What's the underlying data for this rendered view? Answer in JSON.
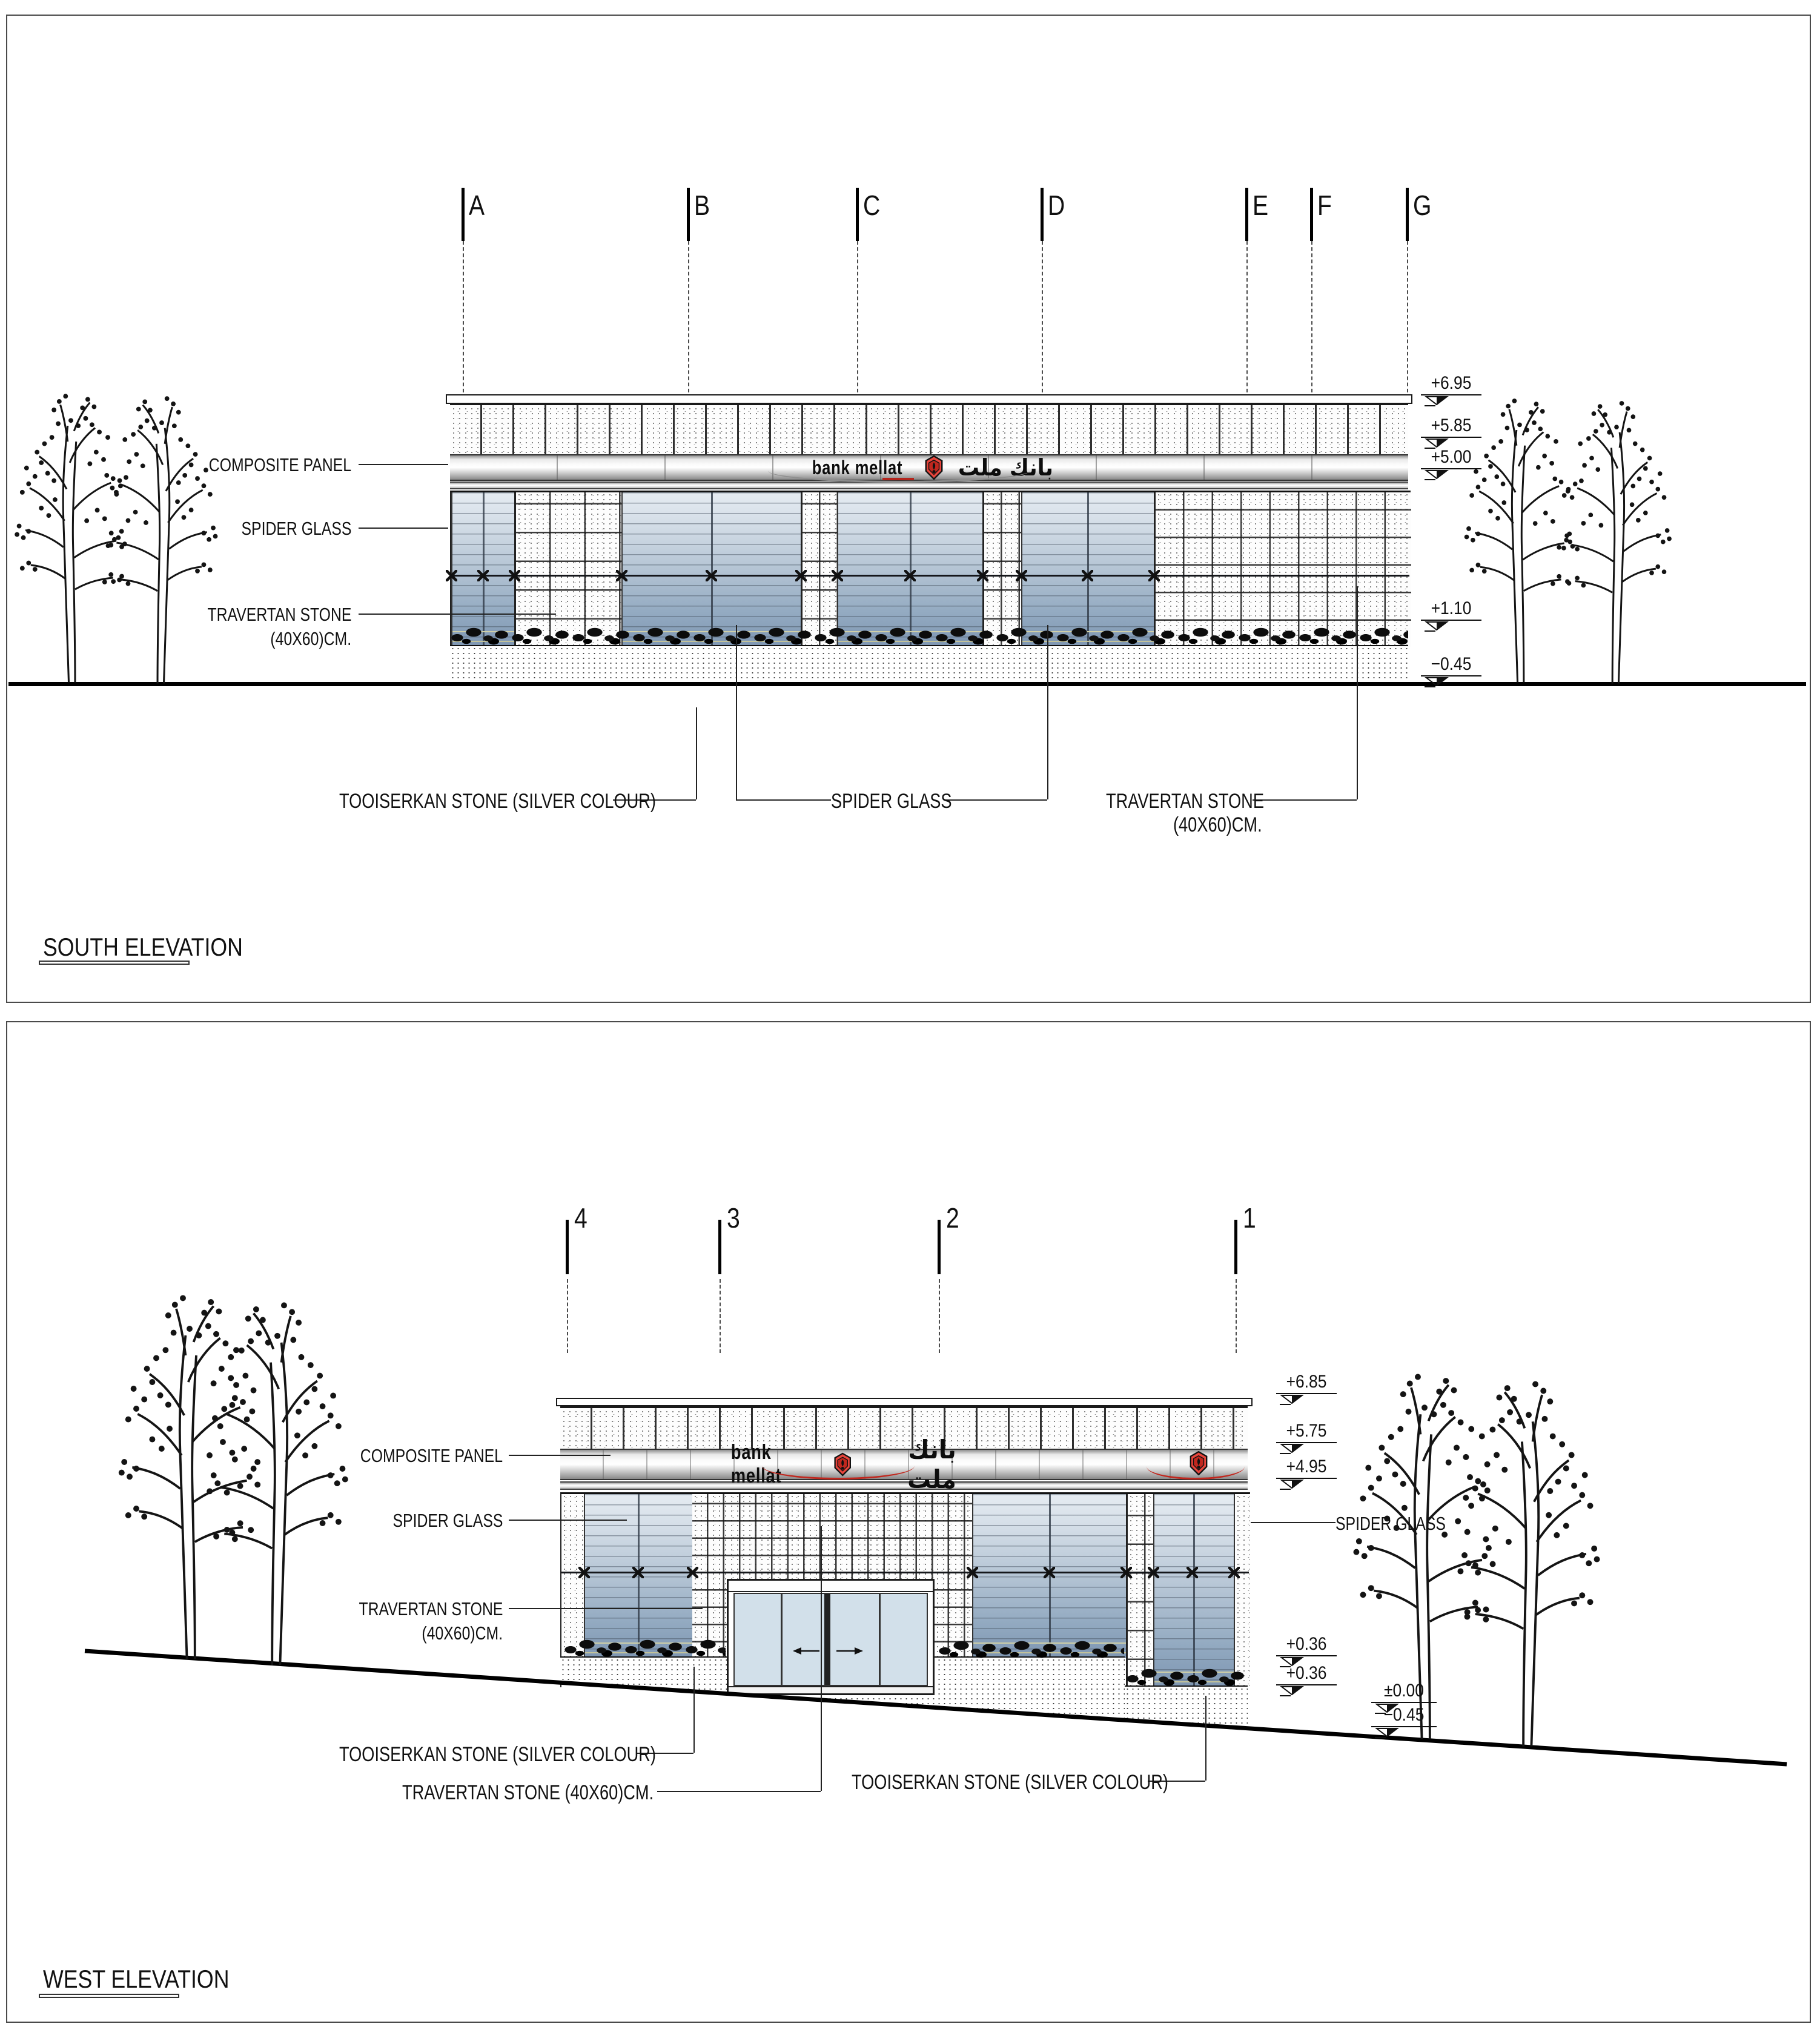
{
  "drawing": {
    "brand": {
      "latin": "bank mellat",
      "persian": "بانك ملت",
      "logo_color": "#d93a31"
    },
    "materials": {
      "composite_panel": "COMPOSITE PANEL",
      "spider_glass": "SPIDER GLASS",
      "travertan_line1": "TRAVERTAN STONE",
      "travertan_line2": "(40X60)CM.",
      "travertan_inline": "TRAVERTAN STONE  (40X60)CM.",
      "tooiserkan": "TOOISERKAN STONE (SILVER COLOUR)"
    },
    "south": {
      "title": "SOUTH ELEVATION",
      "grid": [
        "A",
        "B",
        "C",
        "D",
        "E",
        "F",
        "G"
      ],
      "levels": [
        "+6.95",
        "+5.85",
        "+5.00",
        "+1.10",
        "−0.45"
      ]
    },
    "west": {
      "title": "WEST ELEVATION",
      "grid": [
        "4",
        "3",
        "2",
        "1"
      ],
      "levels": [
        "+6.85",
        "+5.75",
        "+4.95",
        "+0.36",
        "+0.36",
        "±0.00",
        "−0.45"
      ]
    },
    "colors": {
      "glass_top": "#e6ecf2",
      "glass_bottom": "#7e96b2",
      "metal": "#d2d2d2",
      "line": "#1a1a1a",
      "red_accent": "#b3241c"
    }
  }
}
